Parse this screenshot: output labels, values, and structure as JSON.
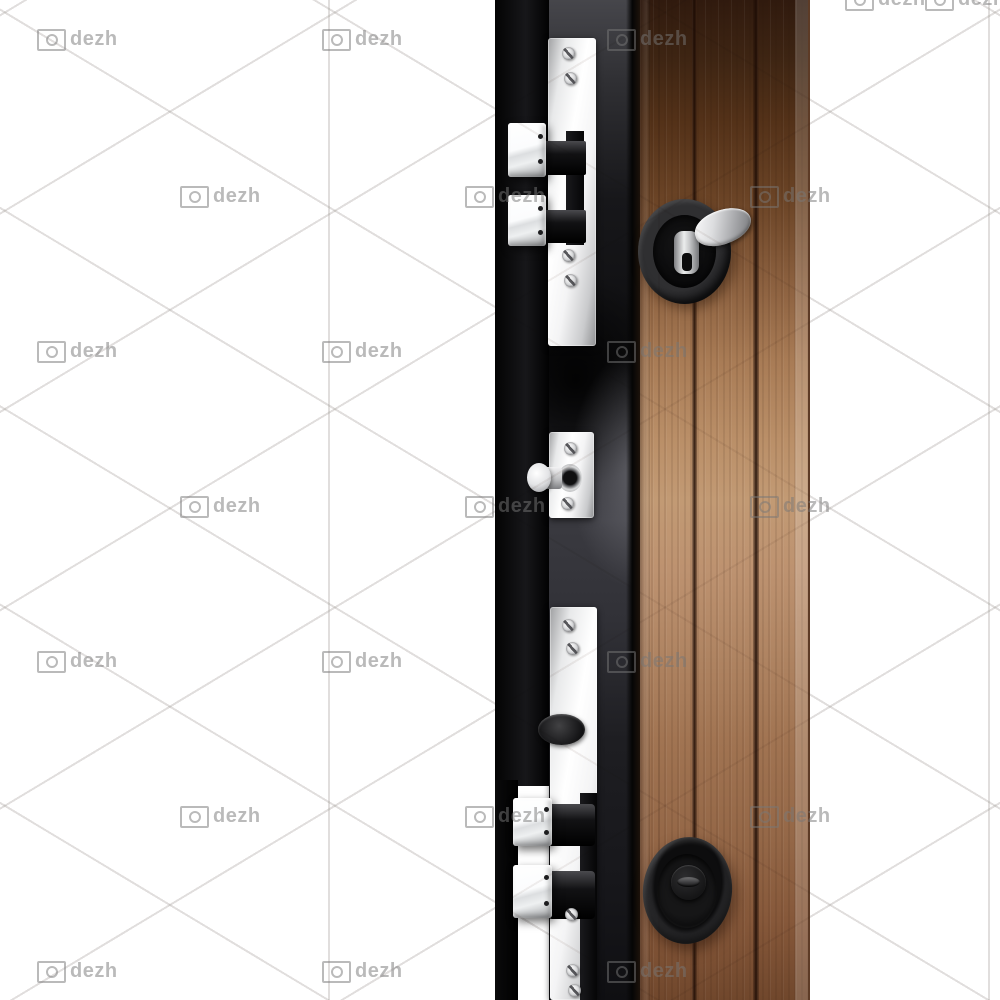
{
  "watermark": {
    "text": "dezh",
    "color": "#787878",
    "opacity": 0.5,
    "positions": [
      {
        "x": 845,
        "y": -12
      },
      {
        "x": 925,
        "y": -12
      },
      {
        "x": 37,
        "y": 28
      },
      {
        "x": 322,
        "y": 28
      },
      {
        "x": 607,
        "y": 28
      },
      {
        "x": 180,
        "y": 185
      },
      {
        "x": 465,
        "y": 185
      },
      {
        "x": 750,
        "y": 185
      },
      {
        "x": 37,
        "y": 340
      },
      {
        "x": 322,
        "y": 340
      },
      {
        "x": 607,
        "y": 340
      },
      {
        "x": 180,
        "y": 495
      },
      {
        "x": 465,
        "y": 495
      },
      {
        "x": 750,
        "y": 495
      },
      {
        "x": 37,
        "y": 650
      },
      {
        "x": 322,
        "y": 650
      },
      {
        "x": 607,
        "y": 650
      },
      {
        "x": 180,
        "y": 805
      },
      {
        "x": 465,
        "y": 805
      },
      {
        "x": 750,
        "y": 805
      },
      {
        "x": 37,
        "y": 960
      },
      {
        "x": 322,
        "y": 960
      },
      {
        "x": 607,
        "y": 960
      }
    ]
  },
  "palette": {
    "background": "#ffffff",
    "pattern_line": "#e8e8e8",
    "frame_black": "#0d0d0e",
    "edge_gray": "#2c2c30",
    "wood_dark": "#3e2513",
    "wood_mid": "#c29a74",
    "wood_deep": "#70472c",
    "chrome": "#f4f4f5",
    "hardware_black": "#1b1b1d"
  },
  "parts": {
    "subject": "steel security door edge with multi-point locks",
    "hardware": [
      "top-double-slide-bolts",
      "thumbturn-escutcheon",
      "middle-pin-bolt",
      "cylinder-keyhole-plate",
      "bottom-double-slide-bolts",
      "round-recessed-keyhole"
    ]
  }
}
